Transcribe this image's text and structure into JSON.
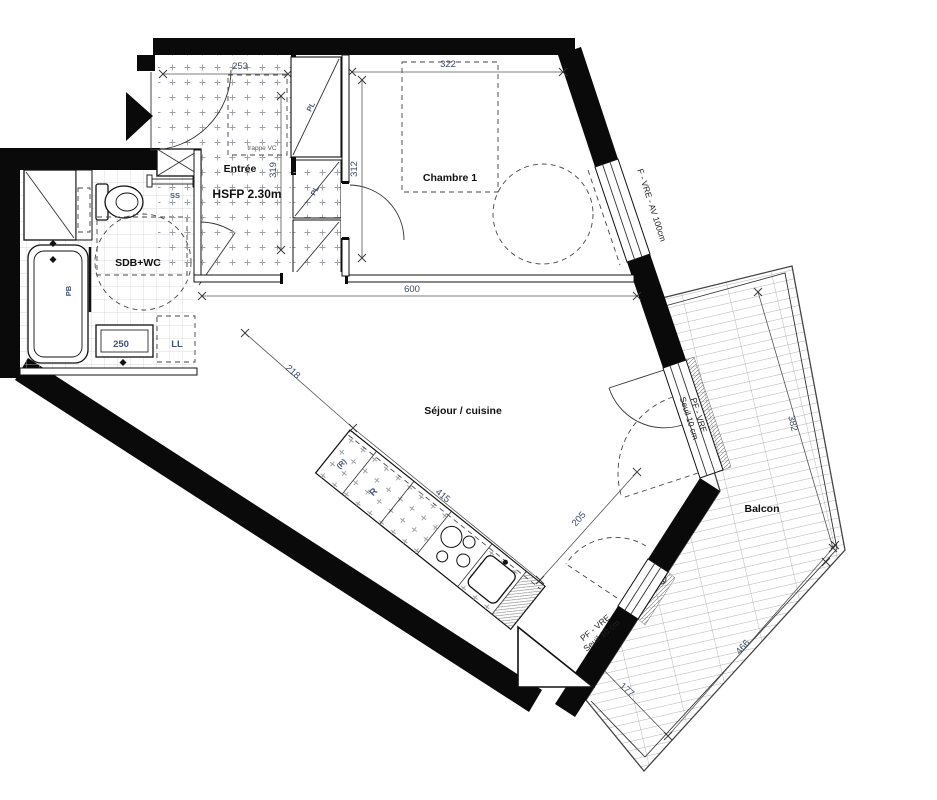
{
  "rooms": {
    "entree": {
      "label": "Entrée",
      "ceiling_note": "HSFP 2.30m"
    },
    "bedroom": {
      "label": "Chambre 1"
    },
    "bathroom": {
      "label": "SDB+WC"
    },
    "living": {
      "label": "Séjour / cuisine"
    },
    "balcony": {
      "label": "Balcon"
    }
  },
  "fixtures": {
    "towel_dryer": "SS",
    "washing_machine": "LL",
    "bath_screen": "PB",
    "closet_upper": "PL",
    "closet_lower": "PL",
    "fridge_reserved": "(R)",
    "fridge": "R",
    "inspection_hatch": "trappe VC",
    "vanity_width": "250"
  },
  "openings": {
    "bedroom_window": "F - VRE - AV 100cm",
    "balcony_door_main": [
      "PF - VRE",
      "Seuil 10 cm"
    ],
    "balcony_door_secondary": [
      "PF - VRE",
      "Seuil 10 cm"
    ]
  },
  "dimensions": {
    "entry_width": "253",
    "entry_depth": "319",
    "bedroom_width": "322",
    "bedroom_depth": "312",
    "living_width": "600",
    "living_diag_a": "218",
    "kitchen_run": "415",
    "living_diag_b": "205",
    "balcony_side": "382",
    "balcony_bottom": "466",
    "balcony_width": "177"
  }
}
